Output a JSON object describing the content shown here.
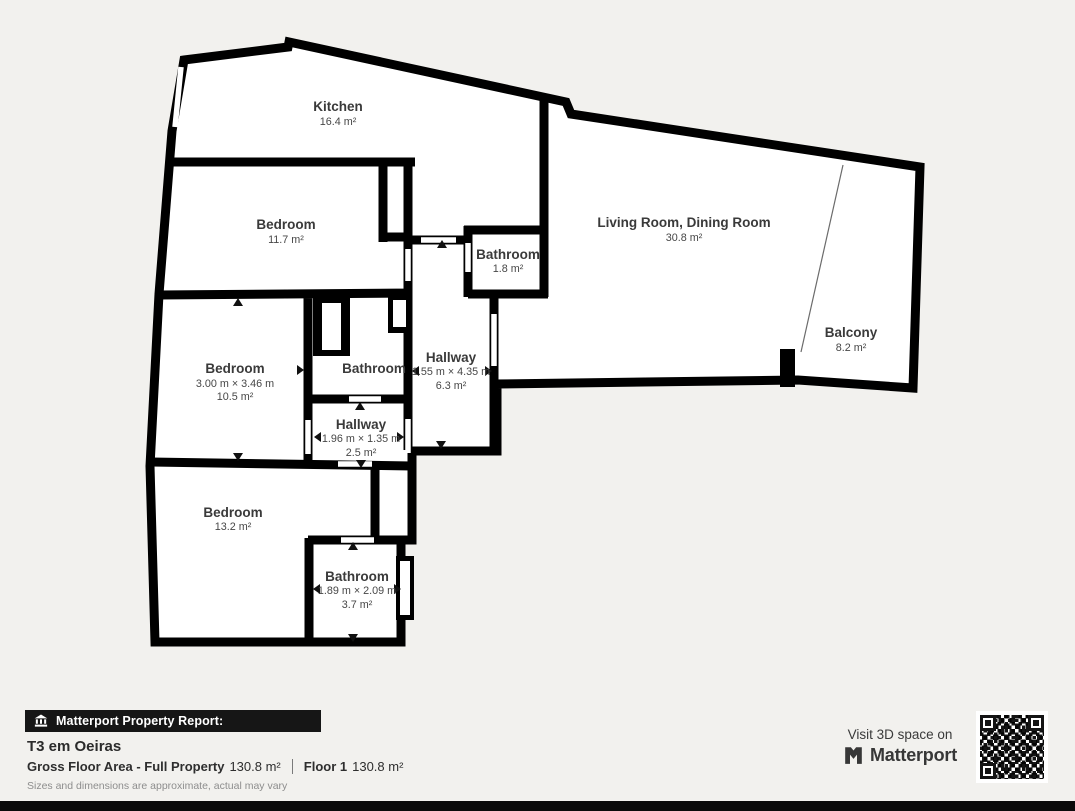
{
  "page": {
    "background_color": "#f2f1ee",
    "wall_color": "#000000",
    "floor_color": "#ffffff",
    "label_color": "#3a3a3a"
  },
  "floorplan": {
    "rooms": [
      {
        "id": "kitchen",
        "name": "Kitchen",
        "area": "16.4 m²"
      },
      {
        "id": "bedroom-top",
        "name": "Bedroom",
        "area": "11.7 m²"
      },
      {
        "id": "bathroom-small",
        "name": "Bathroom",
        "area": "1.8 m²"
      },
      {
        "id": "living-dining",
        "name": "Living Room, Dining Room",
        "area": "30.8 m²"
      },
      {
        "id": "balcony",
        "name": "Balcony",
        "area": "8.2 m²"
      },
      {
        "id": "hallway-main",
        "name": "Hallway",
        "dimensions": "1.55 m × 4.35 m",
        "area": "6.3 m²"
      },
      {
        "id": "bedroom-middle",
        "name": "Bedroom",
        "dimensions": "3.00 m × 3.46 m",
        "area": "10.5 m²"
      },
      {
        "id": "bathroom-middle",
        "name": "Bathroom"
      },
      {
        "id": "hallway-small",
        "name": "Hallway",
        "dimensions": "1.96 m × 1.35 m",
        "area": "2.5 m²"
      },
      {
        "id": "bedroom-bottom",
        "name": "Bedroom",
        "area": "13.2 m²"
      },
      {
        "id": "bathroom-bottom",
        "name": "Bathroom",
        "dimensions": "1.89 m × 2.09 m",
        "area": "3.7 m²"
      }
    ]
  },
  "report": {
    "banner_icon": "building-icon",
    "banner": "Matterport Property Report:",
    "property_title": "T3 em Oeiras",
    "gross_floor_area_label": "Gross Floor Area - Full Property",
    "gross_floor_area_value": "130.8 m²",
    "floor_label": "Floor 1",
    "floor_value": "130.8 m²",
    "disclaimer": "Sizes and dimensions are approximate, actual may vary"
  },
  "cta": {
    "visit_text": "Visit 3D space on",
    "brand": "Matterport",
    "brand_icon": "matterport-logo-icon",
    "qr": "qr-code"
  }
}
